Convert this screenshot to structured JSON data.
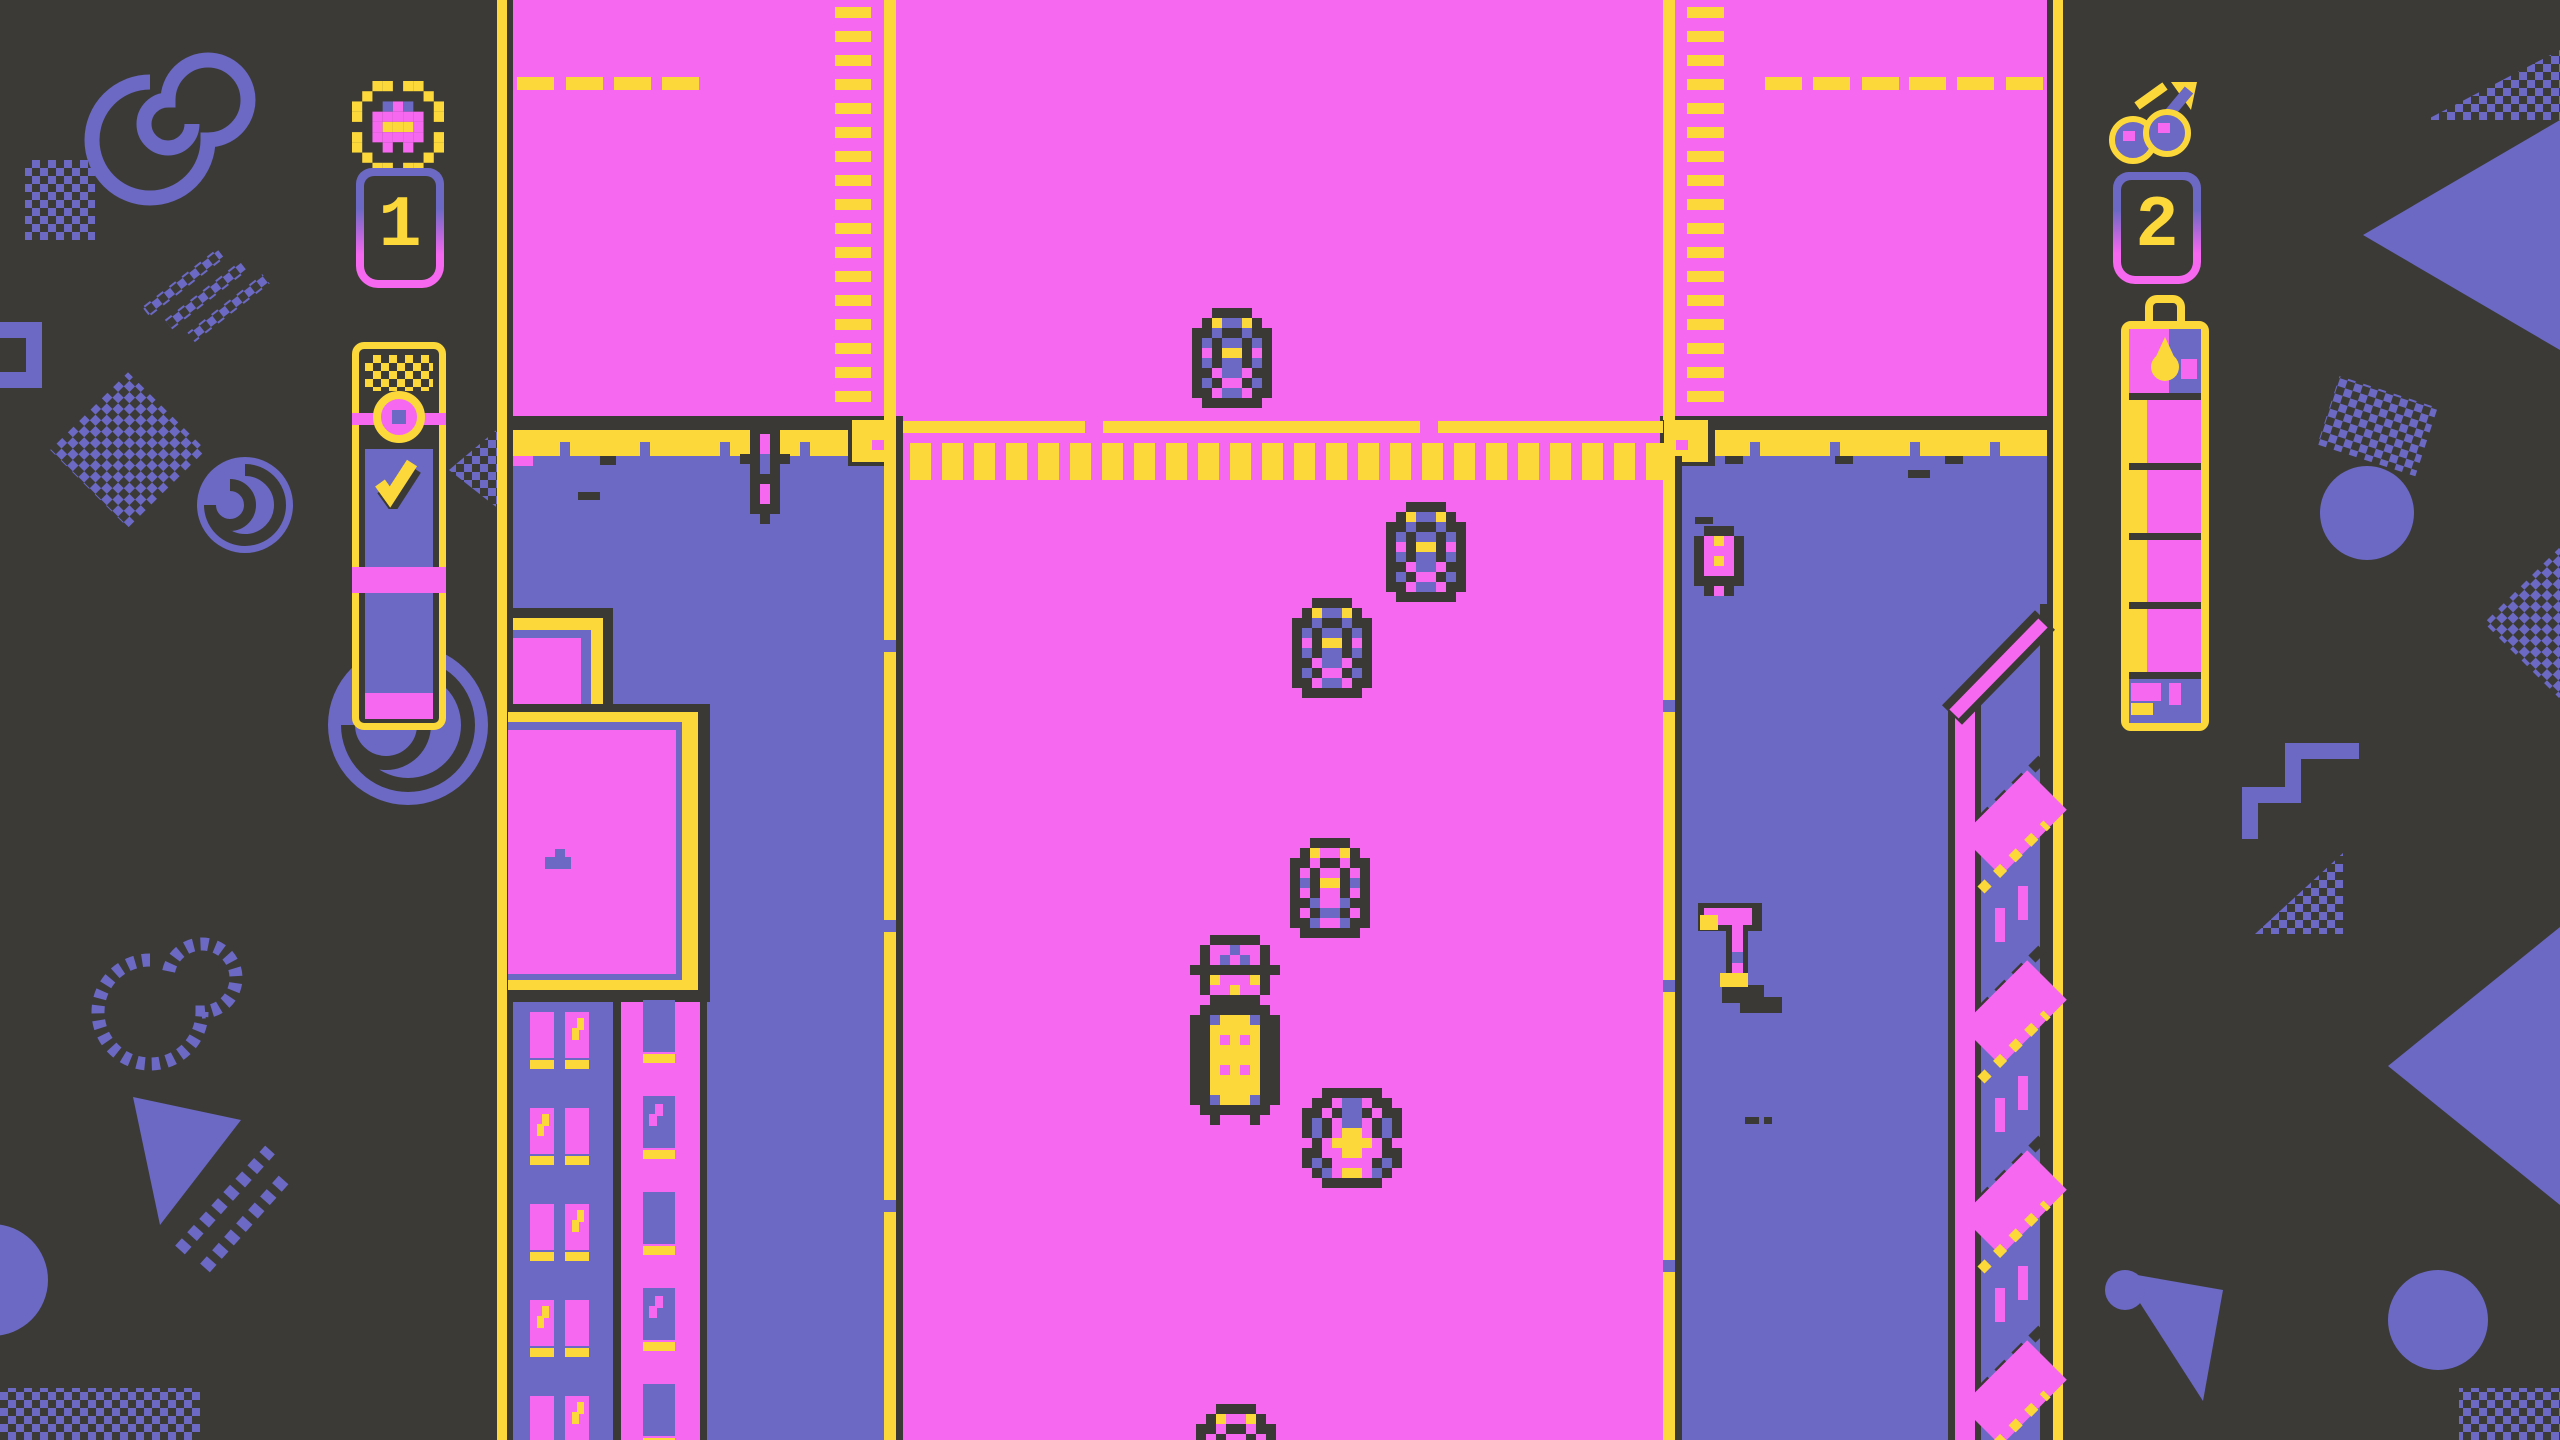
{
  "palette": {
    "bg": "#3b3a37",
    "dark": "#3a3936",
    "pink": "#f568ef",
    "purple": "#6b69c3",
    "yellow": "#fcd83a"
  },
  "hud": {
    "left": {
      "icon": "car-in-wreath",
      "value": "1",
      "meter": {
        "name": "fare-meter",
        "top_icon": "medallion",
        "mark": "checkmark",
        "bottom_fill": "pink"
      }
    },
    "right": {
      "icon": "cherries",
      "value": "2",
      "meter": {
        "name": "fuel-bottle",
        "top_icon": "droplet",
        "segments": 4,
        "filled": 4
      }
    }
  },
  "game": {
    "vehicles": [
      {
        "id": "traffic-car-1",
        "variant": "carDownU",
        "x": 1192,
        "y": 308
      },
      {
        "id": "traffic-car-2",
        "variant": "carDownU",
        "x": 1386,
        "y": 502
      },
      {
        "id": "traffic-car-3",
        "variant": "carDownU",
        "x": 1292,
        "y": 598
      },
      {
        "id": "traffic-car-4",
        "variant": "carDownP",
        "x": 1290,
        "y": 838
      },
      {
        "id": "truck",
        "variant": "truck",
        "x": 1190,
        "y": 935
      },
      {
        "id": "player-car",
        "variant": "sportsUp",
        "x": 1302,
        "y": 1088
      },
      {
        "id": "traffic-car-5",
        "variant": "carDownP",
        "x": 1196,
        "y": 1404
      }
    ],
    "props": [
      {
        "id": "pedestrian",
        "variant": "pedestrian",
        "x": 740,
        "y": 424
      },
      {
        "id": "fire-hydrant",
        "variant": "hydrant",
        "x": 1694,
        "y": 526
      }
    ]
  }
}
